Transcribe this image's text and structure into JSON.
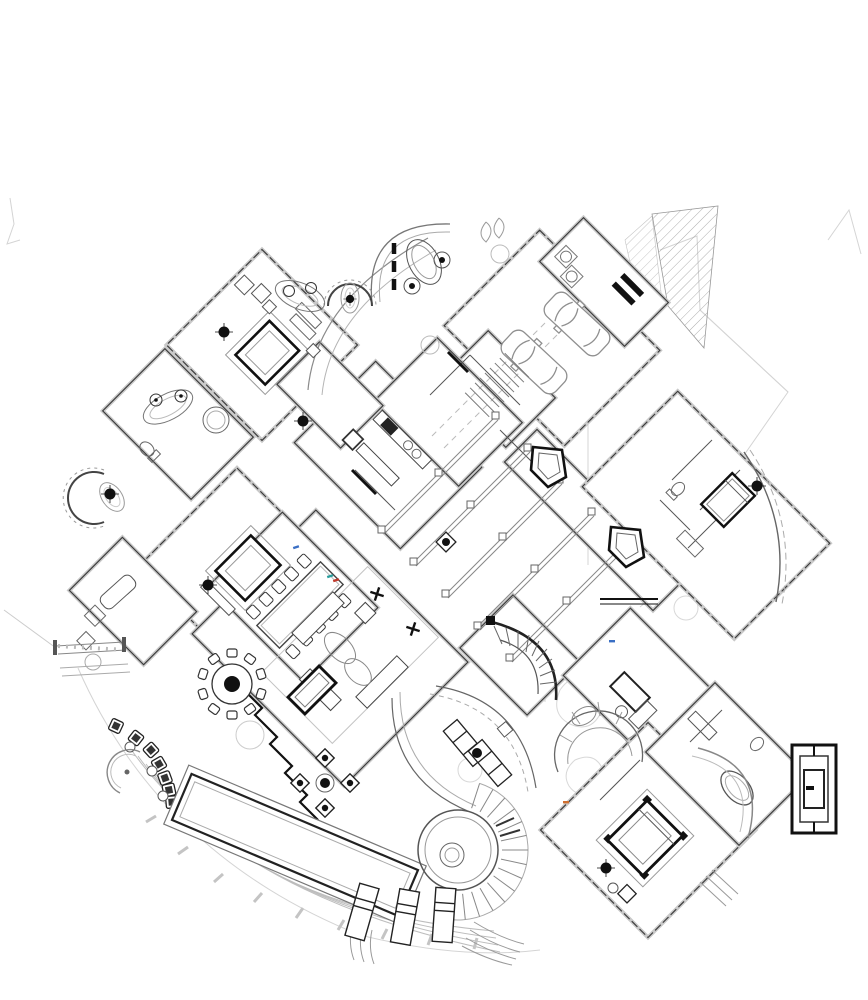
{
  "document": {
    "type": "architectural-floor-plan",
    "description": "Black-and-white CAD floor plan of a large estate residence drawn with wings rotated 45 degrees: garage with two cars and hatched bank at top right, entry court with kidney fountain, turret bay bedrooms on the north-west and west, kitchen and stair hall in the center, pergola beam walkway to an east guest suite with pentagon planters, great room with formal dining, round breakfast table and billiard table, curved lounge with chaise pair, grand curved stair, study, family sectional, south-east master suite with canopy bed, master bath with tub and black media wall, and a lower terrace with lap pool, circular spa with radial steps, sun loungers and an arc of cafe chairs."
  },
  "palette": {
    "background": "#ffffff",
    "linework": "#3a3a3a",
    "heavy_linework": "#111111",
    "light_linework": "#aaaaaa",
    "site_lines": "#d4d4d4",
    "hatch": "#999999",
    "speck_teal": "#2a9d9d",
    "speck_red": "#c0392b",
    "speck_blue": "#3a6fc4",
    "speck_orange": "#d07030"
  },
  "counts": {
    "cars": 2,
    "sun_loungers": 3,
    "dining_chairs": 10,
    "breakfast_chairs": 10,
    "cafe_chair_arc": 7,
    "pergola_beams": 5,
    "pentagon_planters": 2,
    "ceiling_fans": 8,
    "survey_crosses": 2,
    "turret_bays": 2
  },
  "features": [
    {
      "name": "site-boundary",
      "label": "faint property and terrain lines"
    },
    {
      "name": "hatched-bank",
      "label": "diagonal hatched slope at top right"
    },
    {
      "name": "entry-court",
      "label": "curved entry wall with kidney fountain and rosettes"
    },
    {
      "name": "garage",
      "label": "garage with two parked cars"
    },
    {
      "name": "service-stair",
      "label": "straight service stair beside garage"
    },
    {
      "name": "bedroom-northwest",
      "label": "NW bedroom with canopy bed"
    },
    {
      "name": "turret-bay-north",
      "label": "horseshoe turret bay with oval rug"
    },
    {
      "name": "turret-bay-west",
      "label": "west turret bay with oval rug"
    },
    {
      "name": "bath-northwest",
      "label": "bath with twin-sink vanity and round shower"
    },
    {
      "name": "kitchen",
      "label": "kitchen counters with range and stools"
    },
    {
      "name": "bedroom-west",
      "label": "west bedroom with canopy bed"
    },
    {
      "name": "left-deck",
      "label": "railed deck at left edge"
    },
    {
      "name": "pergola-walk",
      "label": "beamed pergola walkway"
    },
    {
      "name": "pentagon-planters",
      "label": "two heavy pentagon planters"
    },
    {
      "name": "guest-suite-east",
      "label": "east guest suite with bed and curved wall"
    },
    {
      "name": "great-room",
      "label": "great room rug with sofas and oval tables"
    },
    {
      "name": "formal-dining",
      "label": "rectangular dining table with ten chairs"
    },
    {
      "name": "breakfast-table",
      "label": "round table with ten chairs"
    },
    {
      "name": "billiard-table",
      "label": "billiard table"
    },
    {
      "name": "grand-stair",
      "label": "curved grand stair"
    },
    {
      "name": "study",
      "label": "study with desk"
    },
    {
      "name": "family-sectional",
      "label": "curved sectional sofa"
    },
    {
      "name": "lounge-pair",
      "label": "two chaises with ball table in curved room"
    },
    {
      "name": "cafe-chair-arc",
      "label": "arc of cafe chairs with half-round bench"
    },
    {
      "name": "cross-cluster",
      "label": "four dark seats around a centre ring"
    },
    {
      "name": "lap-pool",
      "label": "long rectangular lap pool"
    },
    {
      "name": "spa",
      "label": "circular spa with radial step fan"
    },
    {
      "name": "sun-loungers",
      "label": "three sun loungers on terrace"
    },
    {
      "name": "terrace-edge",
      "label": "segmented curved terrace edge"
    },
    {
      "name": "master-suite-southeast",
      "label": "SE master suite with canopy bed"
    },
    {
      "name": "master-bath",
      "label": "master bath with oval tub and curved wall"
    },
    {
      "name": "media-wall",
      "label": "heavy black media wall at east edge"
    }
  ]
}
